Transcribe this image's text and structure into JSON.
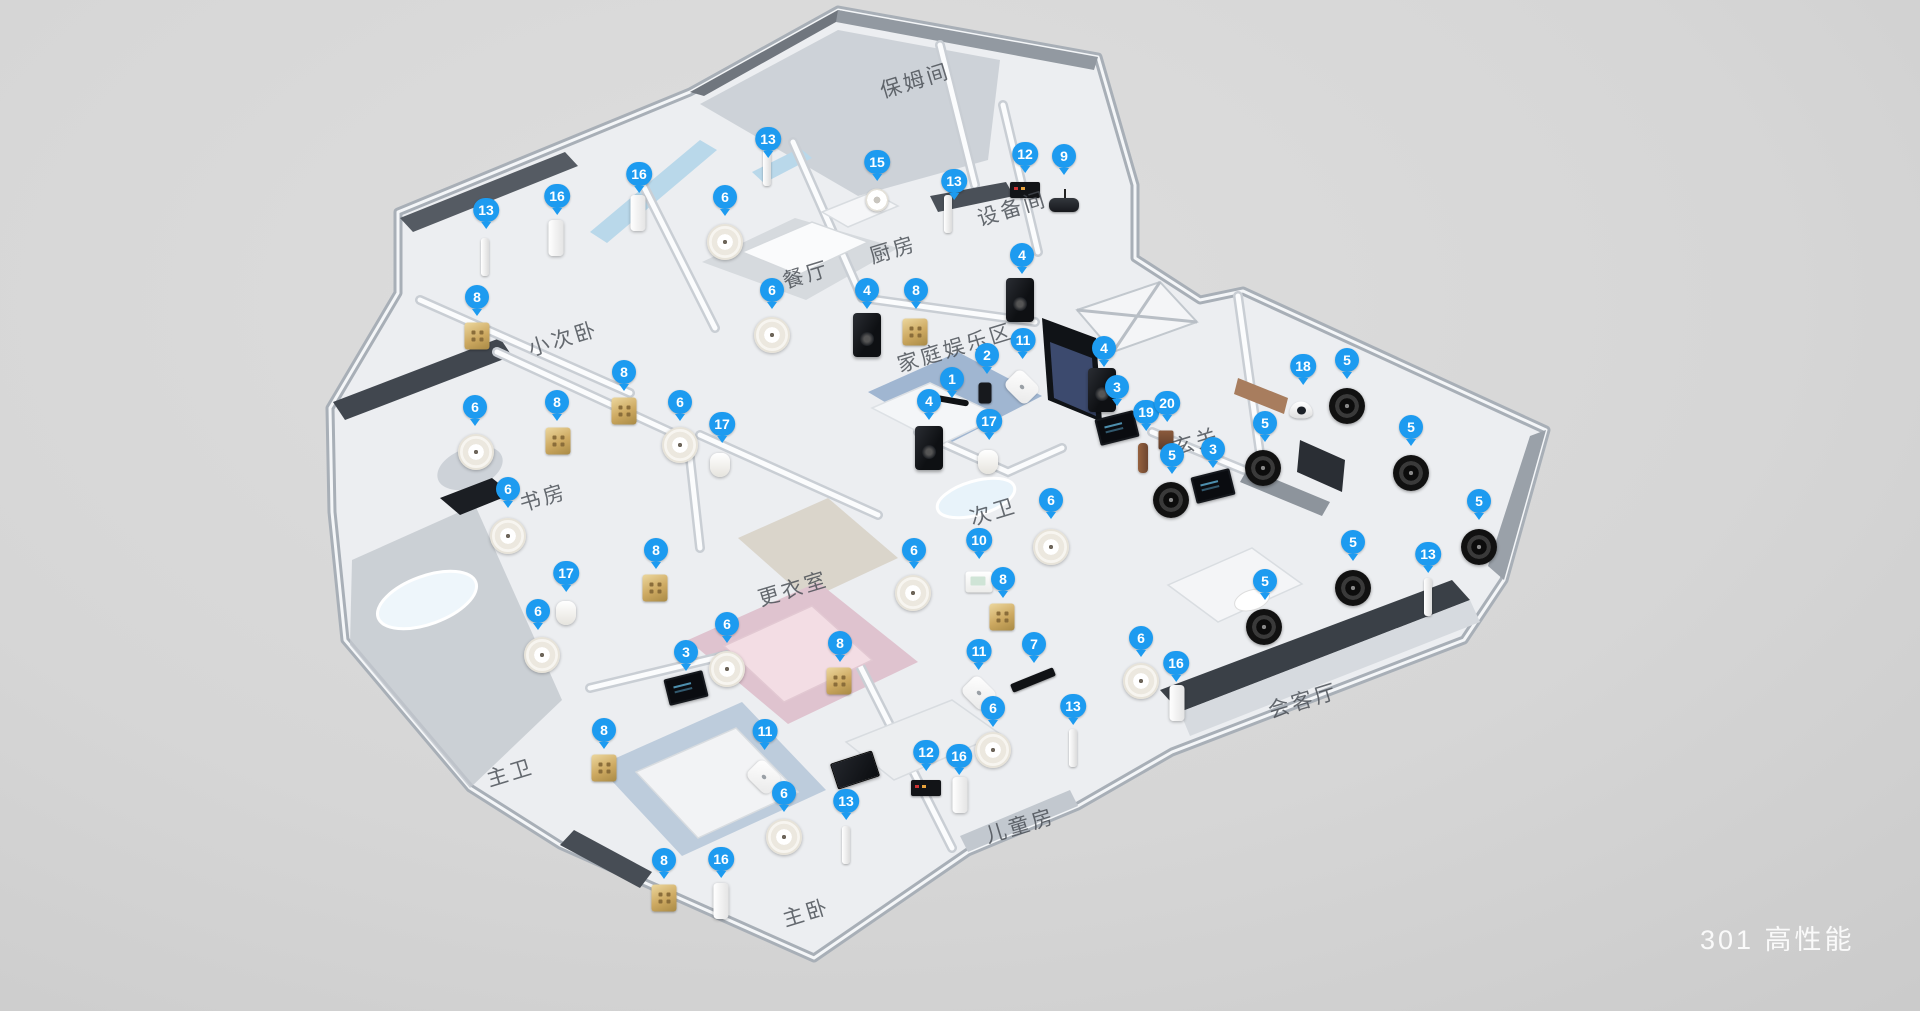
{
  "scene": {
    "caption": "301 高性能",
    "marker_color": "#1d9bf0",
    "background_color": "#d6d6d6"
  },
  "rooms": [
    {
      "label": "保姆间",
      "x": 915,
      "y": 80
    },
    {
      "label": "设备间",
      "x": 1012,
      "y": 208
    },
    {
      "label": "厨房",
      "x": 893,
      "y": 249
    },
    {
      "label": "餐厅",
      "x": 806,
      "y": 274
    },
    {
      "label": "小次卧",
      "x": 563,
      "y": 338
    },
    {
      "label": "家庭娱乐区",
      "x": 955,
      "y": 347
    },
    {
      "label": "玄关",
      "x": 1196,
      "y": 441
    },
    {
      "label": "书房",
      "x": 543,
      "y": 497
    },
    {
      "label": "次卫",
      "x": 993,
      "y": 511
    },
    {
      "label": "更衣室",
      "x": 793,
      "y": 588
    },
    {
      "label": "会客厅",
      "x": 1303,
      "y": 700
    },
    {
      "label": "主卫",
      "x": 510,
      "y": 772
    },
    {
      "label": "儿童房",
      "x": 1020,
      "y": 825
    },
    {
      "label": "主卧",
      "x": 806,
      "y": 912
    }
  ],
  "markers": [
    {
      "n": 13,
      "x": 486,
      "y": 217
    },
    {
      "n": 16,
      "x": 557,
      "y": 203
    },
    {
      "n": 16,
      "x": 639,
      "y": 181
    },
    {
      "n": 13,
      "x": 768,
      "y": 146
    },
    {
      "n": 6,
      "x": 725,
      "y": 204
    },
    {
      "n": 15,
      "x": 877,
      "y": 169
    },
    {
      "n": 13,
      "x": 954,
      "y": 188
    },
    {
      "n": 12,
      "x": 1025,
      "y": 161
    },
    {
      "n": 9,
      "x": 1064,
      "y": 163
    },
    {
      "n": 6,
      "x": 772,
      "y": 297
    },
    {
      "n": 4,
      "x": 867,
      "y": 297
    },
    {
      "n": 8,
      "x": 916,
      "y": 297
    },
    {
      "n": 4,
      "x": 1022,
      "y": 262
    },
    {
      "n": 8,
      "x": 477,
      "y": 304
    },
    {
      "n": 8,
      "x": 557,
      "y": 409
    },
    {
      "n": 8,
      "x": 624,
      "y": 379
    },
    {
      "n": 6,
      "x": 475,
      "y": 414
    },
    {
      "n": 6,
      "x": 680,
      "y": 409
    },
    {
      "n": 17,
      "x": 722,
      "y": 431
    },
    {
      "n": 6,
      "x": 508,
      "y": 496
    },
    {
      "n": 8,
      "x": 656,
      "y": 557
    },
    {
      "n": 17,
      "x": 566,
      "y": 580
    },
    {
      "n": 6,
      "x": 538,
      "y": 618
    },
    {
      "n": 6,
      "x": 727,
      "y": 631
    },
    {
      "n": 3,
      "x": 686,
      "y": 659
    },
    {
      "n": 11,
      "x": 1023,
      "y": 347
    },
    {
      "n": 2,
      "x": 987,
      "y": 362
    },
    {
      "n": 1,
      "x": 952,
      "y": 386
    },
    {
      "n": 4,
      "x": 929,
      "y": 408
    },
    {
      "n": 17,
      "x": 989,
      "y": 428
    },
    {
      "n": 4,
      "x": 1104,
      "y": 355
    },
    {
      "n": 3,
      "x": 1117,
      "y": 394
    },
    {
      "n": 19,
      "x": 1146,
      "y": 419
    },
    {
      "n": 20,
      "x": 1167,
      "y": 410
    },
    {
      "n": 5,
      "x": 1172,
      "y": 462
    },
    {
      "n": 3,
      "x": 1213,
      "y": 456
    },
    {
      "n": 18,
      "x": 1303,
      "y": 373
    },
    {
      "n": 5,
      "x": 1347,
      "y": 367
    },
    {
      "n": 5,
      "x": 1265,
      "y": 430
    },
    {
      "n": 5,
      "x": 1411,
      "y": 434
    },
    {
      "n": 5,
      "x": 1479,
      "y": 508
    },
    {
      "n": 5,
      "x": 1353,
      "y": 549
    },
    {
      "n": 5,
      "x": 1265,
      "y": 588
    },
    {
      "n": 13,
      "x": 1428,
      "y": 561
    },
    {
      "n": 6,
      "x": 1051,
      "y": 507
    },
    {
      "n": 10,
      "x": 979,
      "y": 547
    },
    {
      "n": 6,
      "x": 914,
      "y": 557
    },
    {
      "n": 8,
      "x": 1003,
      "y": 586
    },
    {
      "n": 8,
      "x": 604,
      "y": 737
    },
    {
      "n": 11,
      "x": 765,
      "y": 738
    },
    {
      "n": 6,
      "x": 784,
      "y": 800
    },
    {
      "n": 8,
      "x": 664,
      "y": 867
    },
    {
      "n": 16,
      "x": 721,
      "y": 866
    },
    {
      "n": 13,
      "x": 846,
      "y": 808
    },
    {
      "n": 8,
      "x": 840,
      "y": 650
    },
    {
      "n": 11,
      "x": 979,
      "y": 658
    },
    {
      "n": 7,
      "x": 1034,
      "y": 651
    },
    {
      "n": 12,
      "x": 926,
      "y": 759
    },
    {
      "n": 16,
      "x": 959,
      "y": 763
    },
    {
      "n": 6,
      "x": 993,
      "y": 715
    },
    {
      "n": 13,
      "x": 1073,
      "y": 713
    },
    {
      "n": 6,
      "x": 1141,
      "y": 645
    },
    {
      "n": 16,
      "x": 1176,
      "y": 670
    }
  ],
  "devices": [
    {
      "t": "spkw",
      "x": 725,
      "y": 242
    },
    {
      "t": "spkw",
      "x": 772,
      "y": 335
    },
    {
      "t": "spkw",
      "x": 476,
      "y": 452
    },
    {
      "t": "spkw",
      "x": 680,
      "y": 445
    },
    {
      "t": "spkw",
      "x": 508,
      "y": 536
    },
    {
      "t": "spkw",
      "x": 542,
      "y": 655
    },
    {
      "t": "spkw",
      "x": 727,
      "y": 669
    },
    {
      "t": "spkw",
      "x": 913,
      "y": 593
    },
    {
      "t": "spkw",
      "x": 1051,
      "y": 547
    },
    {
      "t": "spkw",
      "x": 993,
      "y": 750
    },
    {
      "t": "spkw",
      "x": 784,
      "y": 837
    },
    {
      "t": "spkw",
      "x": 1141,
      "y": 681
    },
    {
      "t": "spkb",
      "x": 1171,
      "y": 500
    },
    {
      "t": "spkb",
      "x": 1263,
      "y": 468
    },
    {
      "t": "spkb",
      "x": 1347,
      "y": 406
    },
    {
      "t": "spkb",
      "x": 1411,
      "y": 473
    },
    {
      "t": "spkb",
      "x": 1479,
      "y": 547
    },
    {
      "t": "spkb",
      "x": 1353,
      "y": 588
    },
    {
      "t": "spkb",
      "x": 1264,
      "y": 627
    },
    {
      "t": "tower",
      "x": 867,
      "y": 335
    },
    {
      "t": "tower",
      "x": 929,
      "y": 448
    },
    {
      "t": "tower",
      "x": 1020,
      "y": 300
    },
    {
      "t": "tower",
      "x": 1102,
      "y": 390
    },
    {
      "t": "keypad",
      "x": 477,
      "y": 336
    },
    {
      "t": "keypad",
      "x": 558,
      "y": 441
    },
    {
      "t": "keypad",
      "x": 624,
      "y": 411
    },
    {
      "t": "keypad",
      "x": 915,
      "y": 332
    },
    {
      "t": "keypad",
      "x": 655,
      "y": 588
    },
    {
      "t": "keypad",
      "x": 604,
      "y": 768
    },
    {
      "t": "keypad",
      "x": 664,
      "y": 898
    },
    {
      "t": "keypad",
      "x": 839,
      "y": 681
    },
    {
      "t": "keypad",
      "x": 1002,
      "y": 617
    },
    {
      "t": "motor",
      "x": 556,
      "y": 238
    },
    {
      "t": "motor",
      "x": 638,
      "y": 213
    },
    {
      "t": "motor",
      "x": 721,
      "y": 901
    },
    {
      "t": "motor",
      "x": 960,
      "y": 795
    },
    {
      "t": "motor",
      "x": 1177,
      "y": 703
    },
    {
      "t": "rod",
      "x": 485,
      "y": 257
    },
    {
      "t": "rod",
      "x": 767,
      "y": 167
    },
    {
      "t": "rod",
      "x": 948,
      "y": 214
    },
    {
      "t": "rod",
      "x": 846,
      "y": 845
    },
    {
      "t": "rod",
      "x": 1073,
      "y": 748
    },
    {
      "t": "rod",
      "x": 1428,
      "y": 597
    },
    {
      "t": "screen",
      "x": 1117,
      "y": 428,
      "r": -14
    },
    {
      "t": "screen",
      "x": 1213,
      "y": 486,
      "r": -14
    },
    {
      "t": "screen",
      "x": 686,
      "y": 688,
      "r": -14
    },
    {
      "t": "pir",
      "x": 720,
      "y": 465
    },
    {
      "t": "pir",
      "x": 566,
      "y": 613
    },
    {
      "t": "pir",
      "x": 988,
      "y": 462
    },
    {
      "t": "thermo",
      "x": 979,
      "y": 582
    },
    {
      "t": "ap",
      "x": 1022,
      "y": 387
    },
    {
      "t": "ap",
      "x": 979,
      "y": 693
    },
    {
      "t": "ap",
      "x": 764,
      "y": 777
    },
    {
      "t": "box",
      "x": 1025,
      "y": 190
    },
    {
      "t": "box",
      "x": 926,
      "y": 788
    },
    {
      "t": "router",
      "x": 1064,
      "y": 205
    },
    {
      "t": "smoke",
      "x": 877,
      "y": 200
    },
    {
      "t": "dome",
      "x": 1301,
      "y": 410
    },
    {
      "t": "lock",
      "x": 1143,
      "y": 458
    },
    {
      "t": "bell",
      "x": 1166,
      "y": 440
    },
    {
      "t": "soundbar",
      "x": 1033,
      "y": 680,
      "r": -22
    },
    {
      "t": "tv",
      "x": 855,
      "y": 770,
      "r": -18
    },
    {
      "t": "cam",
      "x": 985,
      "y": 393
    },
    {
      "t": "arm",
      "x": 948,
      "y": 400,
      "r": 10
    }
  ]
}
